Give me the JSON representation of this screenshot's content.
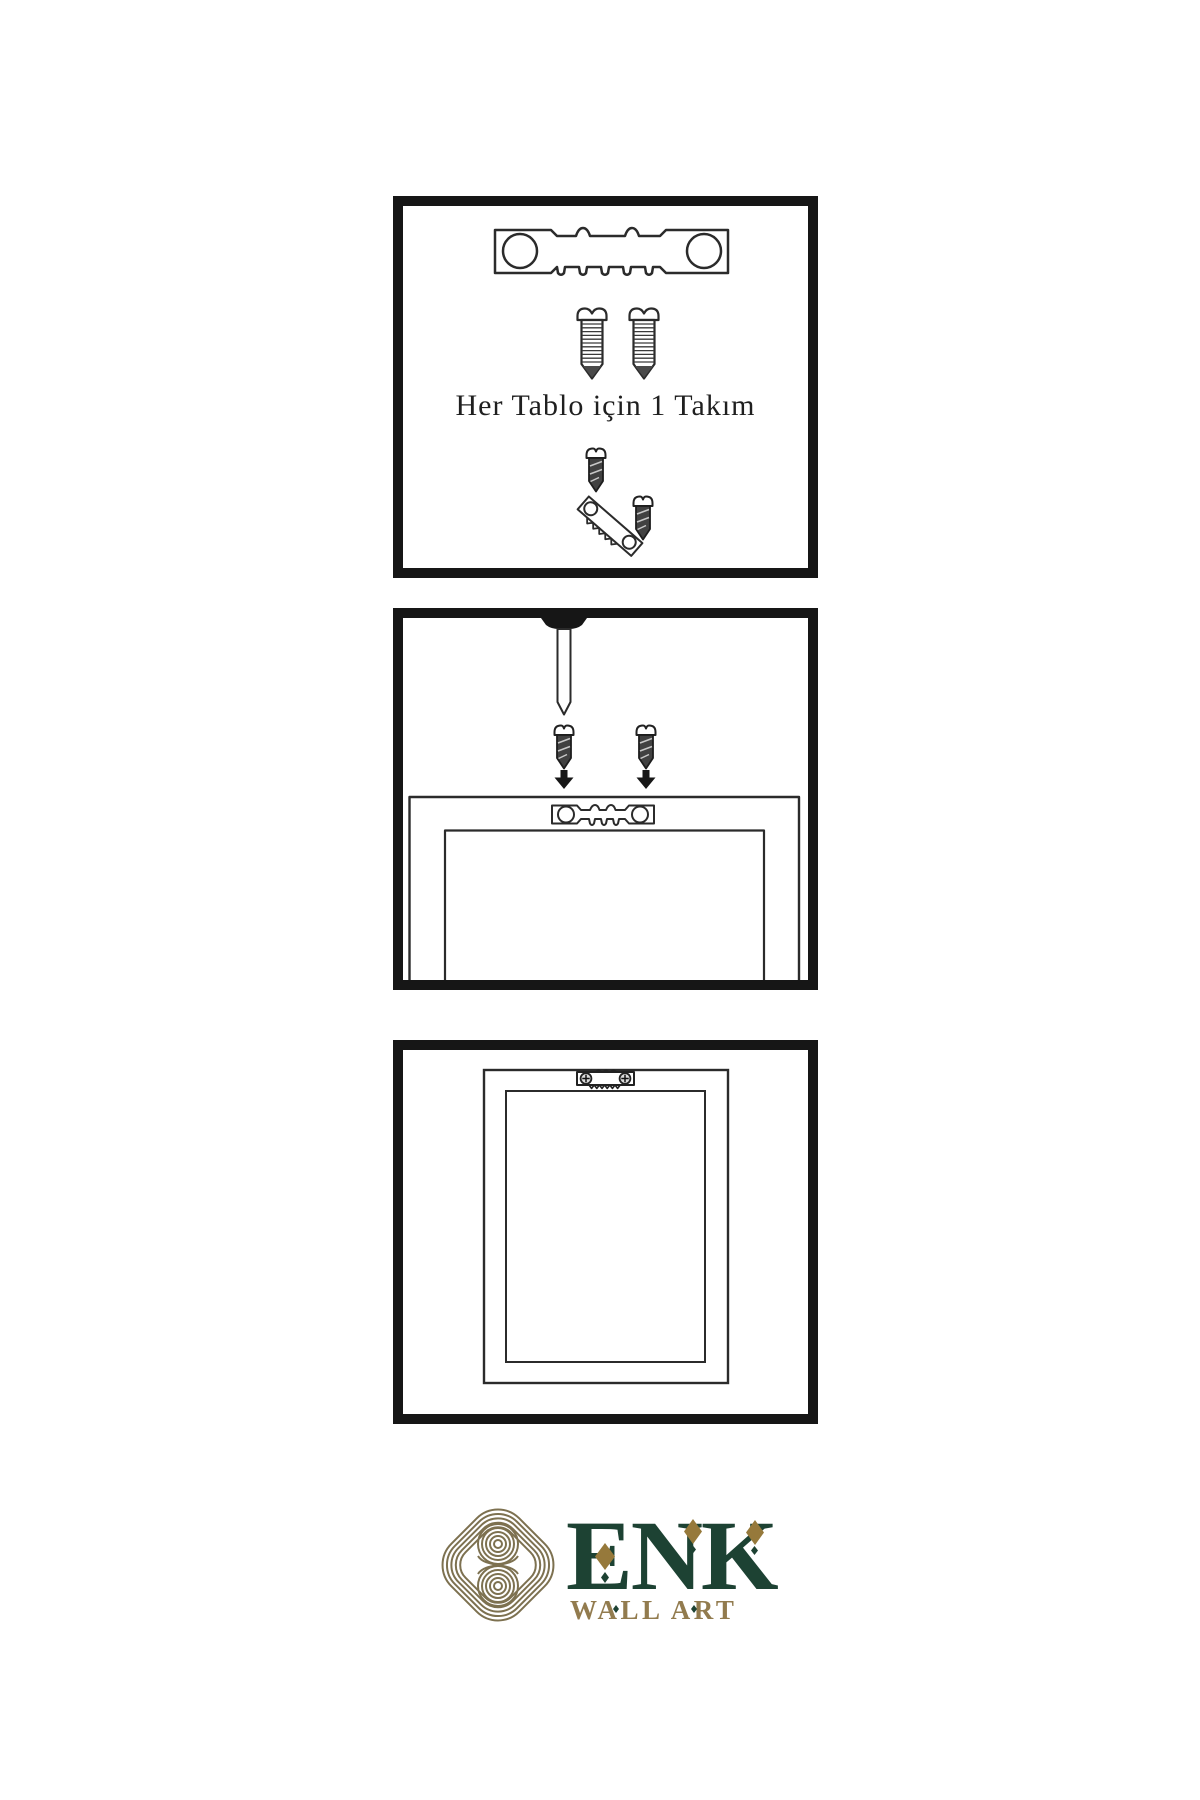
{
  "page": {
    "background": "#ffffff",
    "width": 1200,
    "height": 1800
  },
  "panels": {
    "kit": {
      "caption": "Her Tablo için 1 Takım",
      "items": [
        "sawtooth-hanger",
        "screw",
        "screw",
        "screw-driven-into-angled-hanger",
        "second-screw"
      ]
    },
    "install": {
      "items": [
        "nail-driven-from-top",
        "dark-screw-left",
        "dark-screw-right",
        "arrow-down-left",
        "arrow-down-right",
        "frame-back-outer-edge",
        "frame-back-inner-edge",
        "sawtooth-hanger-on-frame"
      ]
    },
    "result": {
      "items": [
        "wall-frame-back",
        "frame-inner-panel",
        "mounted-sawtooth-hanger-with-screws"
      ]
    }
  },
  "brand": {
    "name": "ENK",
    "subtitle": "WALL ART",
    "colors": {
      "name_green": "#1d4233",
      "diamond_gold": "#96793b",
      "knot_gold": "#7d7150",
      "subtitle_gold": "#927b4e"
    }
  },
  "style": {
    "panel_border": "#161616",
    "line_color": "#2b2b2b",
    "screw_dark_fill": "#414141",
    "caption_color": "#1f1f1f"
  }
}
